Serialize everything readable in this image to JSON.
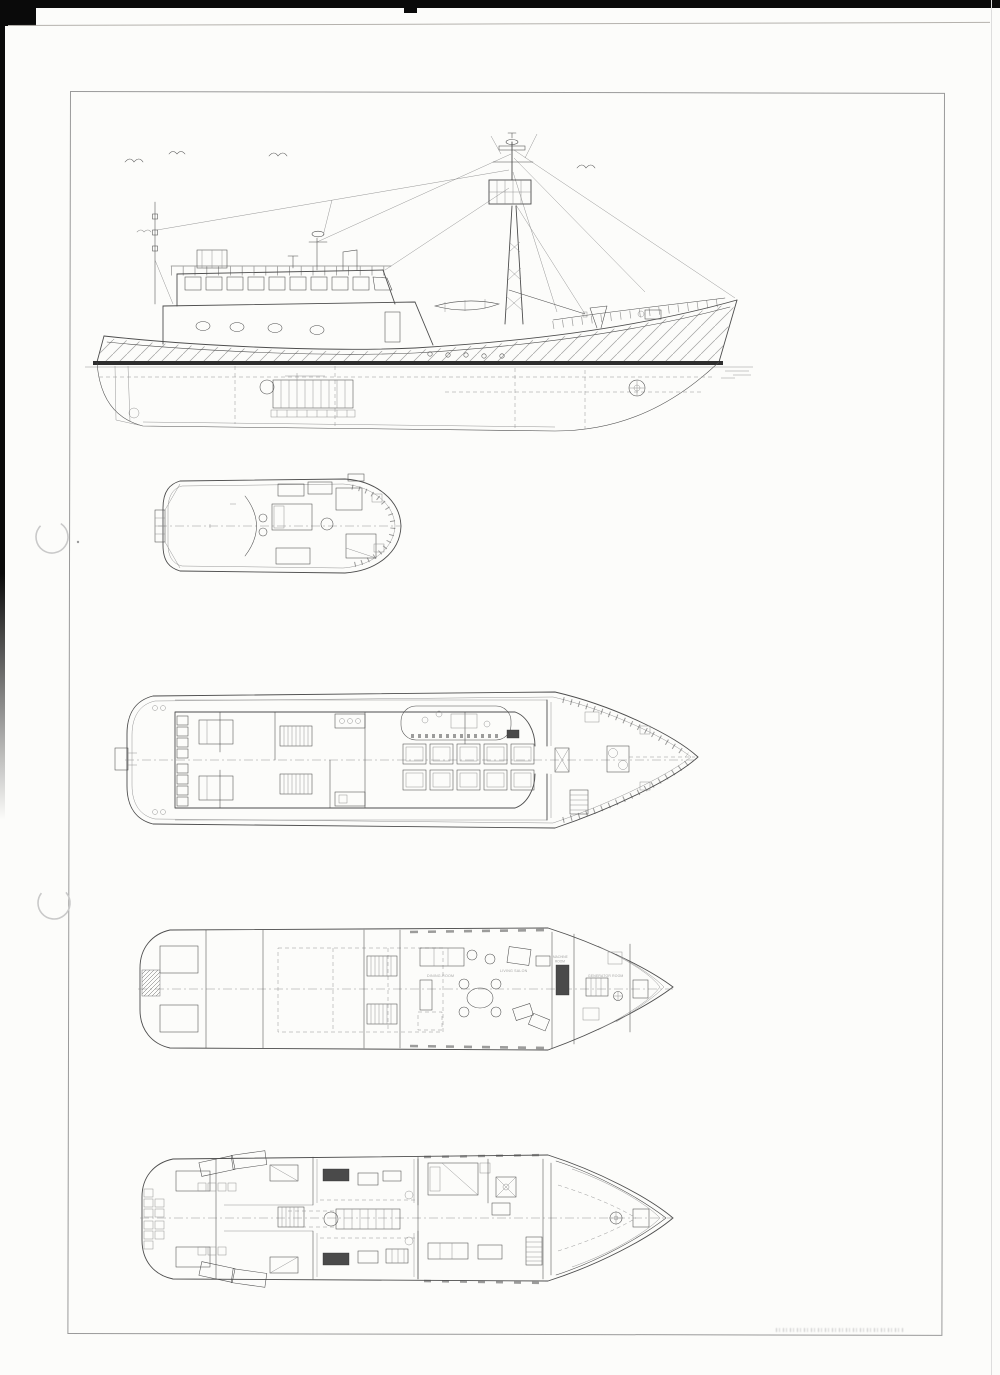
{
  "colors": {
    "paper": "#fcfcfa",
    "ink": "#4d4d4d",
    "ink-light": "#8a8a8a",
    "frame": "#9a9a9a",
    "waterline": "#1c1c1c",
    "scan-black": "#0a0a0a",
    "punch": "#c9c9c9"
  },
  "views": [
    {
      "id": "side-elevation"
    },
    {
      "id": "bridge-deck-plan"
    },
    {
      "id": "main-deck-plan"
    },
    {
      "id": "salon-deck-plan"
    },
    {
      "id": "lower-deck-plan"
    }
  ],
  "deck3_labels": {
    "dining": "DINING-ROOM",
    "living": "LIVING SALON",
    "machine_line1": "MACHINE",
    "machine_line2": "ROOM",
    "generator": "GENERATOR ROOM"
  }
}
